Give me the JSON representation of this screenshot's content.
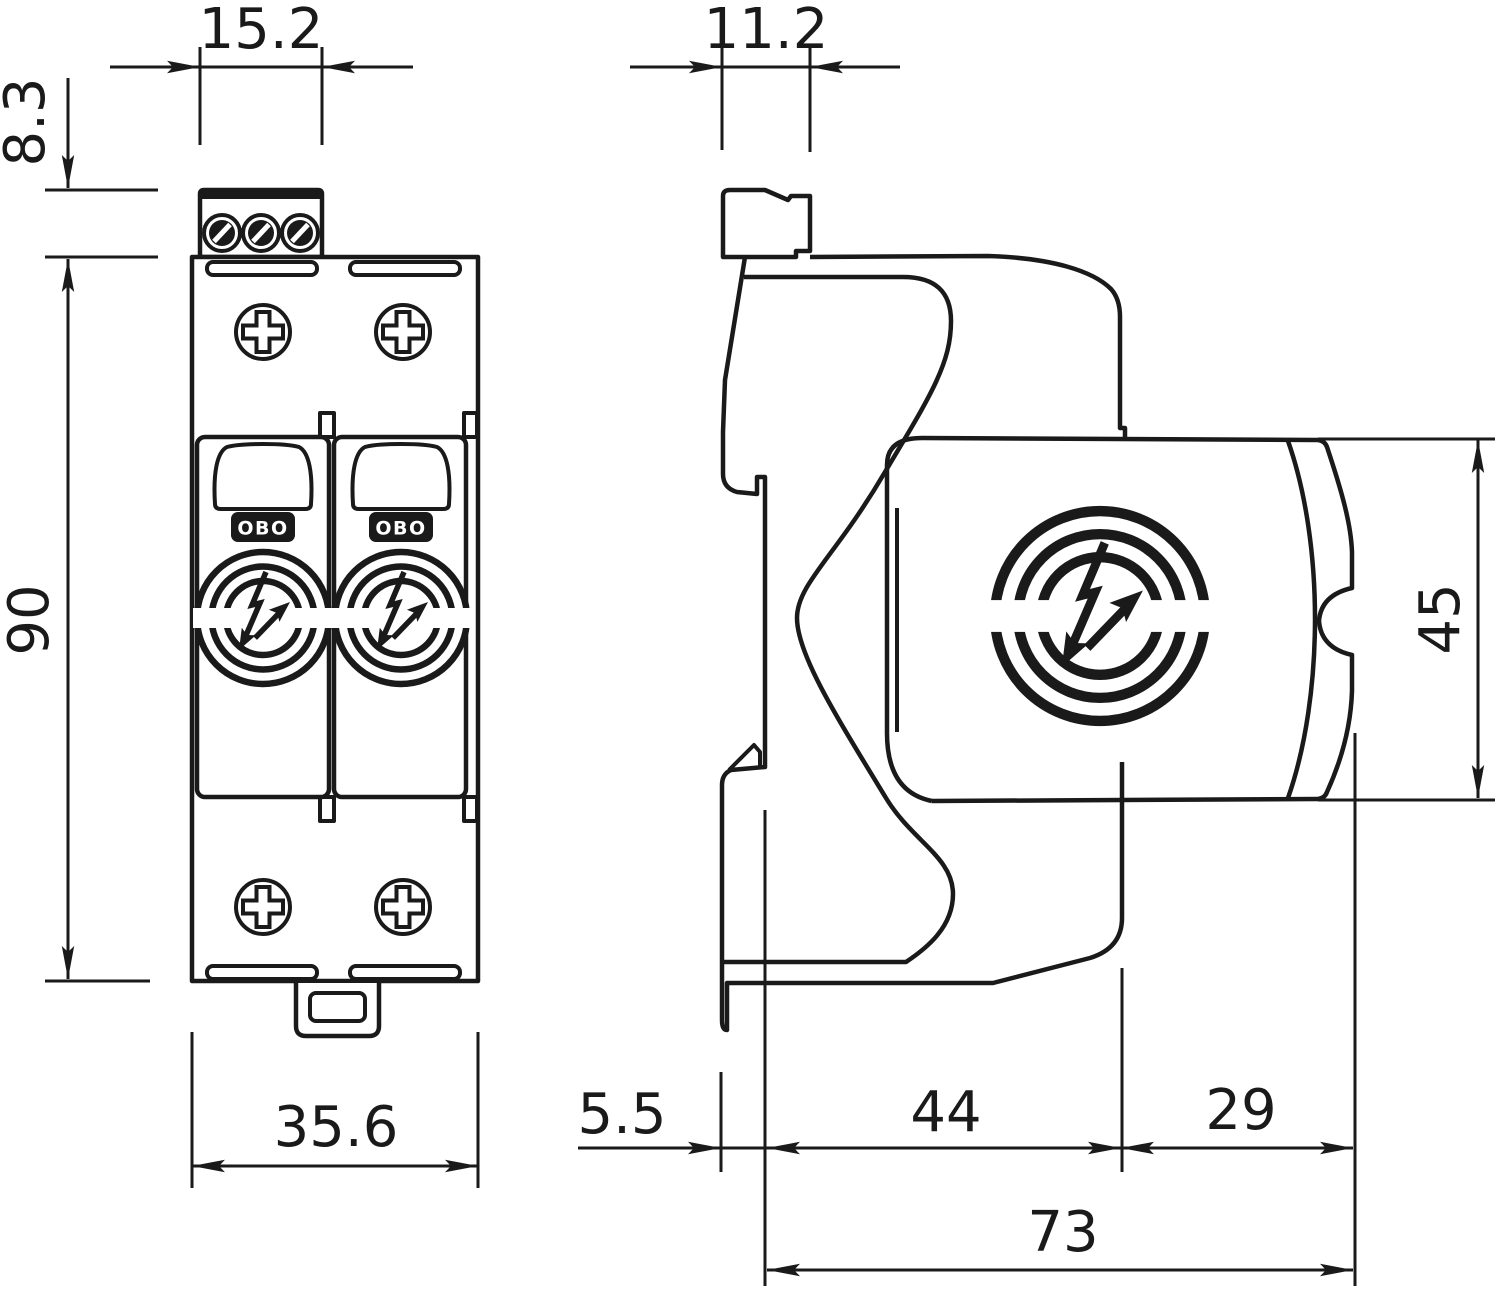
{
  "diagram": {
    "type": "technical-dimension-drawing",
    "subject": "DIN-rail surge protection device, front and side views",
    "unit": "mm",
    "line_color": "#1a1a1a",
    "background_color": "#ffffff",
    "brand": "OBO",
    "front_view": {
      "dims": {
        "terminal_width": "15.2",
        "terminal_height": "8.3",
        "body_height": "90",
        "body_width": "35.6"
      }
    },
    "side_view": {
      "dims": {
        "terminal_width": "11.2",
        "module_height": "45",
        "rail_clip_offset": "5.5",
        "base_depth": "44",
        "module_depth": "29",
        "total_depth": "73"
      }
    },
    "icons": {
      "surge_logo": "circle-rings-with-lightning-arrow",
      "screws": "phillips-and-slotted-terminal-screws"
    }
  }
}
